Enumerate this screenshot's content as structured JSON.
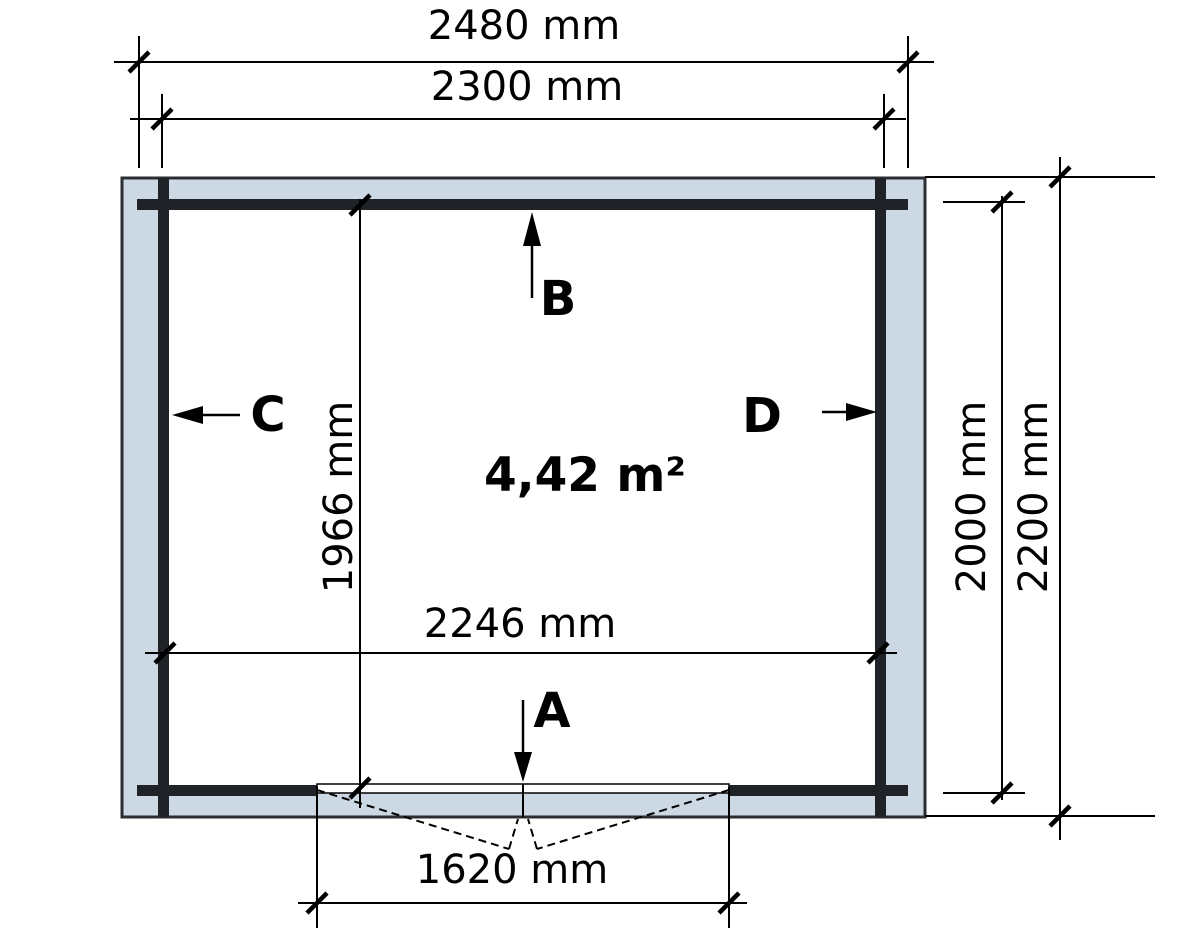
{
  "title": "log-cabin-floor-plan",
  "area_label": "4,42 m²",
  "dimensions": {
    "outer_width_label": "2480 mm",
    "wall_log_width_label": "2300 mm",
    "inner_width_label": "2246 mm",
    "inner_depth_left_label": "1966 mm",
    "door_width_label": "1620 mm",
    "inner_depth_label": "2000 mm",
    "outer_depth_label": "2200 mm"
  },
  "wall_markers": {
    "a": "A",
    "b": "B",
    "c": "C",
    "d": "D"
  },
  "colors": {
    "wall_fill": "#ccd8e3",
    "log": "#1f2226",
    "outline": "#2a2d32",
    "floor": "#ffffff"
  },
  "plan_values": {
    "outer_width_mm": 2480,
    "wall_log_width_mm": 2300,
    "inner_width_mm": 2246,
    "inner_depth_left_mm": 1966,
    "door_width_mm": 1620,
    "inner_depth_mm": 2000,
    "outer_depth_mm": 2200,
    "area_m2": "4,42"
  }
}
